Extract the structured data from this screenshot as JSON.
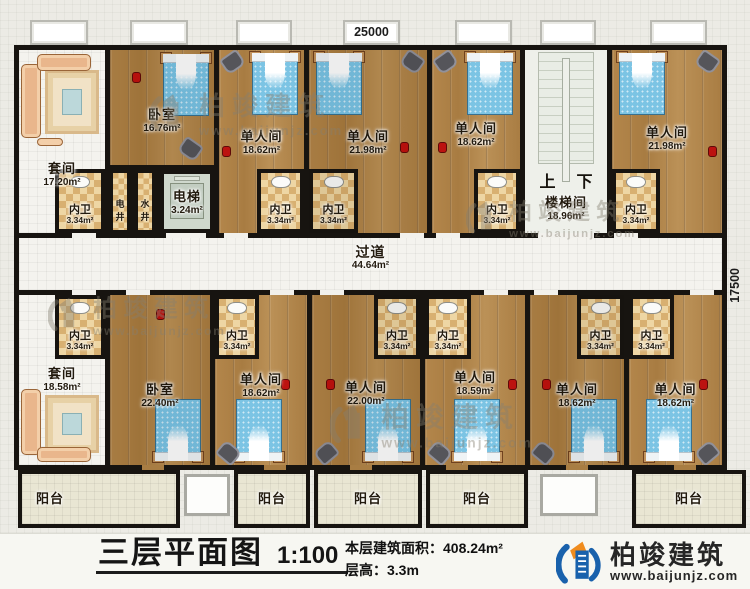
{
  "drawing": {
    "title": "三层平面图",
    "scale": "1:100",
    "area_line": "本层建筑面积：408.24m²",
    "height_line": "层高：3.3m"
  },
  "dimensions": {
    "top": "25000",
    "right": "17500"
  },
  "brand": {
    "name": "柏竣建筑",
    "url": "www.baijunjz.com"
  },
  "rooms": {
    "suite_top": {
      "name": "套间",
      "area": "17.20m²"
    },
    "bedroom_top": {
      "name": "卧室",
      "area": "16.76m²"
    },
    "single_t1": {
      "name": "单人间",
      "area": "18.62m²"
    },
    "single_t2": {
      "name": "单人间",
      "area": "21.98m²"
    },
    "single_t3": {
      "name": "单人间",
      "area": "18.62m²"
    },
    "single_t4": {
      "name": "单人间",
      "area": "21.98m²"
    },
    "stairwell": {
      "name": "楼梯间",
      "area": "18.96m²",
      "up": "上",
      "down": "下"
    },
    "elevator": {
      "name": "电梯",
      "area": "3.24m²"
    },
    "shaft_electric": {
      "name": "电井"
    },
    "shaft_water": {
      "name": "水井"
    },
    "corridor": {
      "name": "过道",
      "area": "44.64m²"
    },
    "suite_bottom": {
      "name": "套间",
      "area": "18.58m²"
    },
    "bedroom_bottom": {
      "name": "卧室",
      "area": "22.40m²"
    },
    "single_b1": {
      "name": "单人间",
      "area": "18.62m²"
    },
    "single_b2": {
      "name": "单人间",
      "area": "22.00m²"
    },
    "single_b3": {
      "name": "单人间",
      "area": "18.59m²"
    },
    "single_b4": {
      "name": "单人间",
      "area": "18.62m²"
    },
    "single_b5": {
      "name": "单人间",
      "area": "18.62m²"
    },
    "bathroom": {
      "name": "内卫",
      "area": "3.34m²"
    },
    "balcony": {
      "name": "阳台"
    }
  },
  "colors": {
    "wall": "#171410",
    "wood": "#b1864b",
    "bath_tile": "#e9cf9a",
    "bed_blue": "#7cc4e4",
    "logo_blue": "#1961ac",
    "logo_orange": "#f08c1e"
  }
}
